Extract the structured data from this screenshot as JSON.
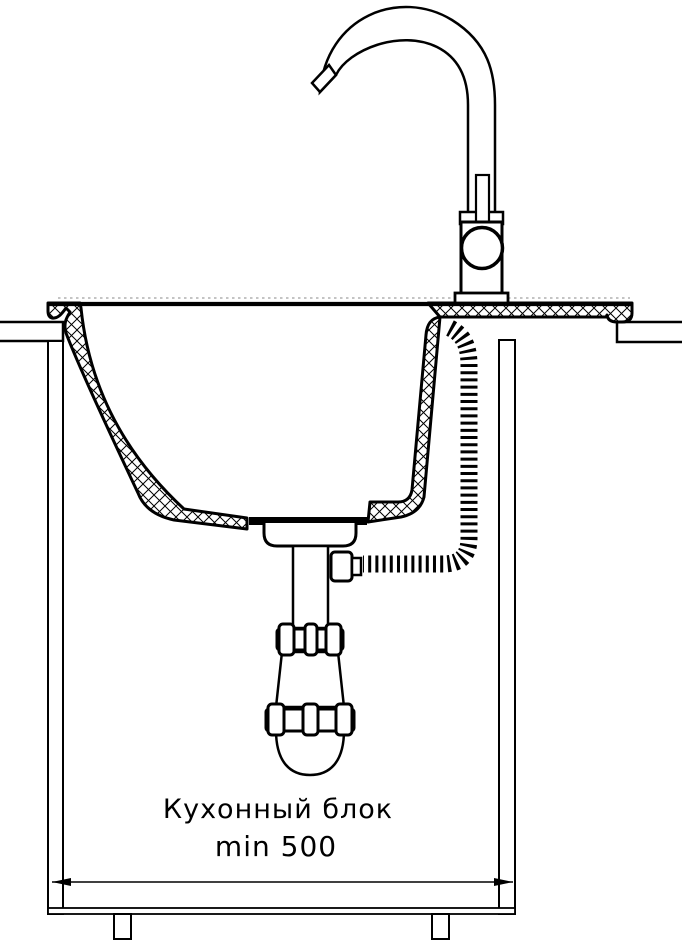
{
  "diagram": {
    "type": "technical-drawing",
    "subject": "kitchen sink installation cross-section",
    "labels": {
      "cabinet": "Кухонный блок",
      "min_width": "min 500"
    },
    "colors": {
      "line": "#000000",
      "background": "#ffffff",
      "reference_line": "#888888"
    },
    "components": [
      "gooseneck-spout",
      "faucet-mixer-body",
      "sink-bowl",
      "countertop-left",
      "countertop-right",
      "flexible-corrugated-hose",
      "drain-cup",
      "drain-tailpipe",
      "siphon-trap",
      "kitchen-cabinet",
      "width-dimension-arrow"
    ]
  }
}
